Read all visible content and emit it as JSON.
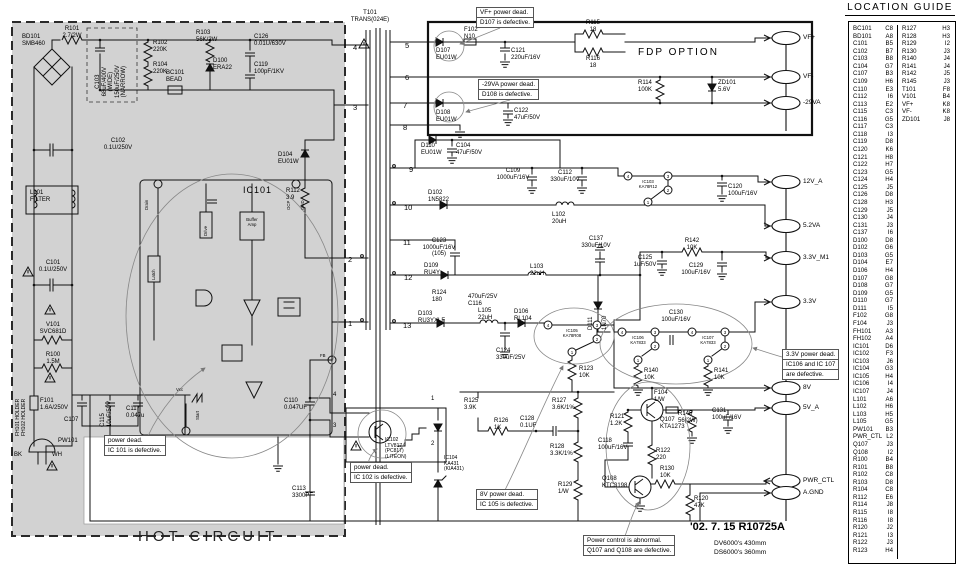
{
  "regions": {
    "hot": "HOT CIRCUIT",
    "fdp": "FDP OPTION"
  },
  "notes": {
    "date": "'02. 7. 15 R10725A",
    "dv": "DV6000's 430mm",
    "ds": "DS6000's 360mm"
  },
  "outputs": {
    "vf_plus": "VF+",
    "vf_minus": "VF-",
    "neg29": "-29VA",
    "v12": "12V_A",
    "v52": "5.2VA",
    "v33m1": "3.3V_M1",
    "v33": "3.3V",
    "v8": "8V",
    "v5": "5V_A",
    "pwrctl": "PWR_CTL",
    "agnd": "A.GND"
  },
  "pins": {
    "1": "1",
    "2": "2",
    "3": "3",
    "4": "4",
    "5": "5",
    "6": "6",
    "7": "7",
    "8": "8",
    "9": "9",
    "10": "10",
    "11": "11",
    "12": "12",
    "13": "13"
  },
  "blocks": {
    "drain": "Drain",
    "drive": "Drive",
    "latch": "Latch",
    "buffer": "Buffer\nAmp",
    "ocp": "OCP",
    "gnd": "GND",
    "vcc": "Vcc",
    "start": "Start",
    "fb": "FB"
  },
  "c": {
    "bd101": "BD101\nSMB460",
    "r101": "R101\n2.7/2W",
    "c103": "C103\n68uF/400V\n(WIDE)\n150uF/250V\n(NARROW)",
    "r102": "R102\n220K",
    "r104": "R104\n220K",
    "bc101": "BC101\nBEAD",
    "r103": "R103\n56K/2W",
    "d100": "D100\nERA22",
    "c126": "C126\n0.01U/630V",
    "c119": "C119\n100pF/1KV",
    "c102": "C102\n0.1U/250V",
    "l101": "L101\nFILTER",
    "c101": "C101\n0.1U/250V",
    "v101": "V101\nSVC681D",
    "r100": "R100\n1.5M",
    "f101": "F101\n1.6A/250V",
    "fh": "FH101 HOLDER\nFH102 HOLDER",
    "c107": "C107",
    "c115": "C115\n10uF/50V",
    "c117": "C117\n0.047u",
    "pw101": "PW101",
    "bk": "BK",
    "wh": "WH",
    "c110": "C110\n0.047UF",
    "c113": "C113\n3300PF",
    "d104": "D104\nEU01W",
    "r112": "R112\n3.9",
    "ic101": "IC101",
    "t101": "T101\nTRANS(024E)",
    "d107": "D107\nEU01W",
    "f102": "F102\nN10",
    "c121": "C121\n220uF/16V",
    "d108": "D108\nEU01W",
    "c122": "C122\n47uF/50V",
    "r115": "R115\n18",
    "r116": "R116\n18",
    "r114": "R114\n100K",
    "zd101": "ZD101\n5.6V",
    "d110": "D110\nEU01W",
    "c104": "C104\n47uF/50V",
    "c109": "C109\n1000uF/16V",
    "c112": "C112\n330uF/10V",
    "d102": "D102\n1N5822",
    "l102": "L102\n20uH",
    "ic103": "IC103\nKA78R12",
    "c120": "C120\n100uF/16V",
    "c123": "C123\n1000uF/16V\n(105)",
    "d109": "D109\nRU4Y",
    "l103": "L103\n22uH",
    "r124": "R124\n180",
    "c116": "470uF/25V\nC116",
    "d103": "D103\nRU3YXLF",
    "l105": "L105\n22uH",
    "d106": "D106\nRL104",
    "c124": "C124\n330uF/25V",
    "ic105": "IC105\nKA78R08",
    "r123": "R123\n10K",
    "c137": "C137\n330uF/10V",
    "r142": "R142\n10K",
    "c125": "C125\n1uF/50V",
    "c129": "C129\n100uF/16V",
    "d111": "D111",
    "d111p": "1N70",
    "c130": "C130\n100uF/16V",
    "ic106": "IC106\nKA7833",
    "ic107": "IC107\nKA7833",
    "r140": "R140\n10K",
    "r141": "R141\n10K",
    "r125": "R125\n3.9K",
    "r126": "R126\n1K",
    "ic102": "IC102\nLTV817\n(PC817)\n(LITEON)",
    "ic104": "IC104\nKA431\n(KIA431)",
    "r127": "R127\n3.6K/1%",
    "c128": "C128\n0.1UF",
    "r128": "R128\n3.3K/1%",
    "r129": "R129\n1/W",
    "r121": "R121\n1.2K",
    "q107": "Q107\nKTA1273",
    "f104": "F104\n1/W",
    "r145": "R145\n56(2W)",
    "c131": "C131\n100uF/16V",
    "c118": "C118\n100uF/16V",
    "r122": "R122\n220",
    "r130": "R130\n10K",
    "q108": "Q108\nKTC3198",
    "r120": "R120\n47K"
  },
  "callouts": {
    "vf": [
      "VF+ power dead.",
      "D107 is defective."
    ],
    "n29": [
      "-29VA power dead.",
      "D108 is defective."
    ],
    "ic101": [
      "power dead.",
      "IC 101 is defective."
    ],
    "ic102": [
      "power dead.",
      "IC 102 is defective."
    ],
    "v8": [
      "8V power dead.",
      "IC 105 is defective."
    ],
    "v33": [
      "3.3V power dead.",
      "IC106 and IC 107",
      "are defective."
    ],
    "pwr": [
      "Power control is abnormal.",
      "Q107 and Q108 are defective."
    ]
  },
  "location_guide": {
    "title": "LOCATION GUIDE",
    "col1": [
      {
        "r": "BC101",
        "g": "C8"
      },
      {
        "r": "BD101",
        "g": "A8"
      },
      {
        "r": "C101",
        "g": "B5"
      },
      {
        "r": "C102",
        "g": "B7"
      },
      {
        "r": "C103",
        "g": "B8"
      },
      {
        "r": "C104",
        "g": "G7"
      },
      {
        "r": "C107",
        "g": "B3"
      },
      {
        "r": "C109",
        "g": "H6"
      },
      {
        "r": "C110",
        "g": "E3"
      },
      {
        "r": "C112",
        "g": "I6"
      },
      {
        "r": "C113",
        "g": "E2"
      },
      {
        "r": "C115",
        "g": "C3"
      },
      {
        "r": "C116",
        "g": "G5"
      },
      {
        "r": "C117",
        "g": "C3"
      },
      {
        "r": "C118",
        "g": "I3"
      },
      {
        "r": "C119",
        "g": "D8"
      },
      {
        "r": "C120",
        "g": "K6"
      },
      {
        "r": "C121",
        "g": "H8"
      },
      {
        "r": "C122",
        "g": "H7"
      },
      {
        "r": "C123",
        "g": "G5"
      },
      {
        "r": "C124",
        "g": "H4"
      },
      {
        "r": "C125",
        "g": "J5"
      },
      {
        "r": "C126",
        "g": "D8"
      },
      {
        "r": "C128",
        "g": "H3"
      },
      {
        "r": "C129",
        "g": "J5"
      },
      {
        "r": "C130",
        "g": "J4"
      },
      {
        "r": "C131",
        "g": "J3"
      },
      {
        "r": "C137",
        "g": "I6"
      },
      {
        "r": "D100",
        "g": "D8"
      },
      {
        "r": "D102",
        "g": "G6"
      },
      {
        "r": "D103",
        "g": "G5"
      },
      {
        "r": "D104",
        "g": "E7"
      },
      {
        "r": "D106",
        "g": "H4"
      },
      {
        "r": "D107",
        "g": "G8"
      },
      {
        "r": "D108",
        "g": "G7"
      },
      {
        "r": "D109",
        "g": "G5"
      },
      {
        "r": "D110",
        "g": "G7"
      },
      {
        "r": "D111",
        "g": "I5"
      },
      {
        "r": "F102",
        "g": "G8"
      },
      {
        "r": "F104",
        "g": "J3"
      },
      {
        "r": "FH101",
        "g": "A3"
      },
      {
        "r": "FH102",
        "g": "A4"
      },
      {
        "r": "IC101",
        "g": "D6"
      },
      {
        "r": "IC102",
        "g": "F3"
      },
      {
        "r": "IC103",
        "g": "J6"
      },
      {
        "r": "IC104",
        "g": "G3"
      },
      {
        "r": "IC105",
        "g": "H4"
      },
      {
        "r": "IC106",
        "g": "I4"
      },
      {
        "r": "IC107",
        "g": "J4"
      },
      {
        "r": "L101",
        "g": "A6"
      },
      {
        "r": "L102",
        "g": "H6"
      },
      {
        "r": "L103",
        "g": "H5"
      },
      {
        "r": "L105",
        "g": "G5"
      },
      {
        "r": "PW101",
        "g": "B3"
      },
      {
        "r": "PWR_CTL",
        "g": "L2"
      },
      {
        "r": "Q107",
        "g": "J3"
      },
      {
        "r": "Q108",
        "g": "I2"
      },
      {
        "r": "R100",
        "g": "B4"
      },
      {
        "r": "R101",
        "g": "B8"
      },
      {
        "r": "R102",
        "g": "C8"
      },
      {
        "r": "R103",
        "g": "D8"
      },
      {
        "r": "R104",
        "g": "C8"
      },
      {
        "r": "R112",
        "g": "E6"
      },
      {
        "r": "R114",
        "g": "J8"
      },
      {
        "r": "R115",
        "g": "I8"
      },
      {
        "r": "R116",
        "g": "I8"
      },
      {
        "r": "R120",
        "g": "J2"
      },
      {
        "r": "R121",
        "g": "I3"
      },
      {
        "r": "R122",
        "g": "J3"
      },
      {
        "r": "R123",
        "g": "H4"
      }
    ],
    "col2": [
      {
        "r": "R127",
        "g": "H3"
      },
      {
        "r": "R128",
        "g": "H3"
      },
      {
        "r": "R129",
        "g": "I2"
      },
      {
        "r": "R130",
        "g": "J3"
      },
      {
        "r": "R140",
        "g": "J4"
      },
      {
        "r": "R141",
        "g": "J4"
      },
      {
        "r": "R142",
        "g": "J5"
      },
      {
        "r": "R145",
        "g": "J3"
      },
      {
        "r": "T101",
        "g": "F8"
      },
      {
        "r": "V101",
        "g": "B4"
      },
      {
        "r": "VF+",
        "g": "K8"
      },
      {
        "r": "VF-",
        "g": "K8"
      },
      {
        "r": "ZD101",
        "g": "J8"
      }
    ]
  }
}
